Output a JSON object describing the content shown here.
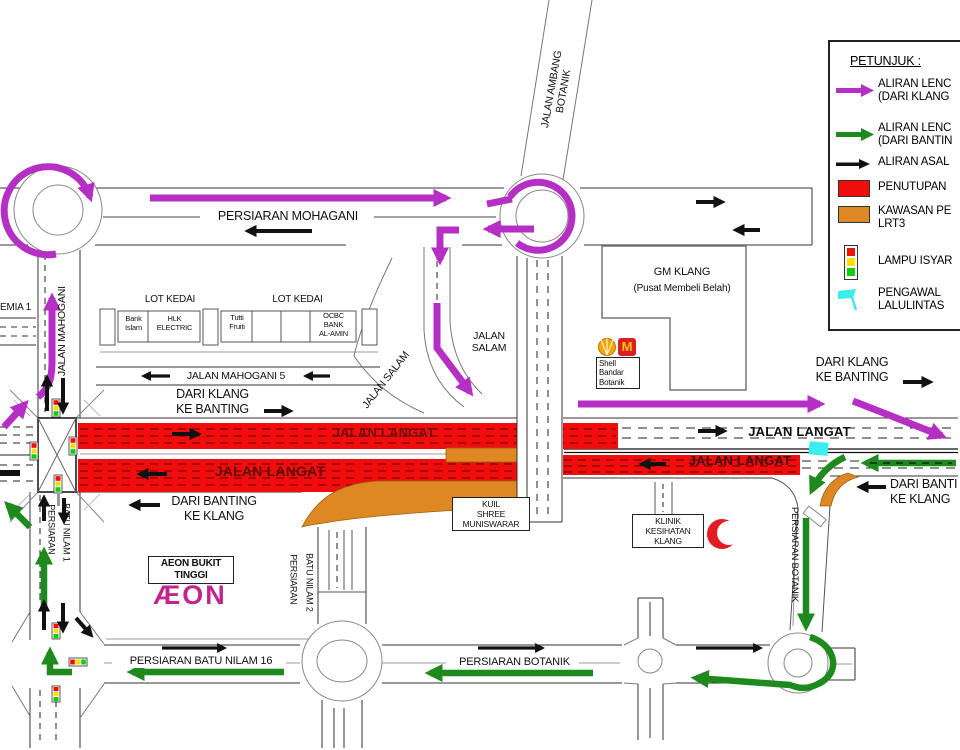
{
  "colors": {
    "magenta": "#B62FC4",
    "green": "#1E8A1E",
    "closure_red": "#F20D0D",
    "lrt_orange": "#DD8822",
    "cyan": "#3BEDED",
    "dark_red_text": "#6B1111",
    "aeon_pink": "#C2268B",
    "mcd_red": "#DA1F26",
    "mcd_yellow": "#FFC800",
    "shell_orange": "#F6A800",
    "crescent_red": "#E31B23",
    "signal_red": "#EE1100",
    "signal_yellow": "#FFDD00",
    "signal_green": "#11CC11"
  },
  "legend": {
    "title": "PETUNJUK :",
    "items": [
      {
        "icon": "magenta-arrow",
        "label": "ALIRAN LENC\n(DARI KLANG"
      },
      {
        "icon": "green-arrow",
        "label": "ALIRAN LENC\n(DARI BANTIN"
      },
      {
        "icon": "black-arrow",
        "label": "ALIRAN ASAL"
      },
      {
        "icon": "red-swatch",
        "label": "PENUTUPAN"
      },
      {
        "icon": "orange-swatch",
        "label": "KAWASAN PE\nLRT3"
      },
      {
        "icon": "traffic-light",
        "label": "LAMPU ISYAR"
      },
      {
        "icon": "cyan-flag",
        "label": "PENGAWAL\nLALULINTAS"
      }
    ]
  },
  "roads": {
    "persiaran_mohagani": "PERSIARAN MOHAGANI",
    "jalan_ambang_botanik": "JALAN AMBANG\nBOTANIK",
    "jalan_mahogani": "JALAN MAHOGANI",
    "jalan_mahogani_5": "JALAN MAHOGANI 5",
    "jalan_salam_diagonal": "JALAN SALAM",
    "jalan_salam_stacked": "JALAN\nSALAM",
    "jalan_langat_upper_left": "JALAN LANGAT",
    "jalan_langat_lower_left": "JALAN LANGAT",
    "jalan_langat_upper_right": "JALAN LANGAT",
    "jalan_langat_lower_right": "JALAN LANGAT",
    "persiaran_batu_nilam_1_line1": "PERSIARAN",
    "persiaran_batu_nilam_1_line2": "BATU NILAM 1",
    "persiaran_batu_nilam_2_line1": "PERSIARAN",
    "persiaran_batu_nilam_2_line2": "BATU NILAM 2",
    "persiaran_batu_nilam_16": "PERSIARAN BATU NILAM 16",
    "persiaran_botanik_horizontal": "PERSIARAN BOTANIK",
    "persiaran_botanik_vertical": "PERSIARAN BOTANIK",
    "emia_1": "EMIA 1"
  },
  "directions": {
    "from_klang_west": "DARI KLANG\nKE BANTING",
    "from_banting_west": "DARI BANTING\nKE KLANG",
    "from_klang_east": "DARI KLANG\nKE BANTING",
    "from_banting_east": "DARI BANTI\nKE KLANG"
  },
  "places": {
    "lot_kedai_left": "LOT KEDAI",
    "lot_kedai_right": "LOT KEDAI",
    "bank_islam": "Bank\nIslam",
    "hlk_electric": "HLK\nELECTRIC",
    "tutti_fruiti": "Tutti\nFruiti",
    "ocbc": "OCBC\nBANK\nAL-AMIN",
    "gm_klang": "GM KLANG",
    "gm_klang_sub": "(Pusat Membeli Belah)",
    "shell": "Shell\nBandar\nBotanik",
    "mcdonalds_m": "M",
    "kuil": "KUIL\nSHREE\nMUNISWARAR",
    "klinik": "KLINIK\nKESIHATAN\nKLANG",
    "aeon_sign": "AEON BUKIT\nTINGGI",
    "aeon_logo": "ÆON"
  }
}
